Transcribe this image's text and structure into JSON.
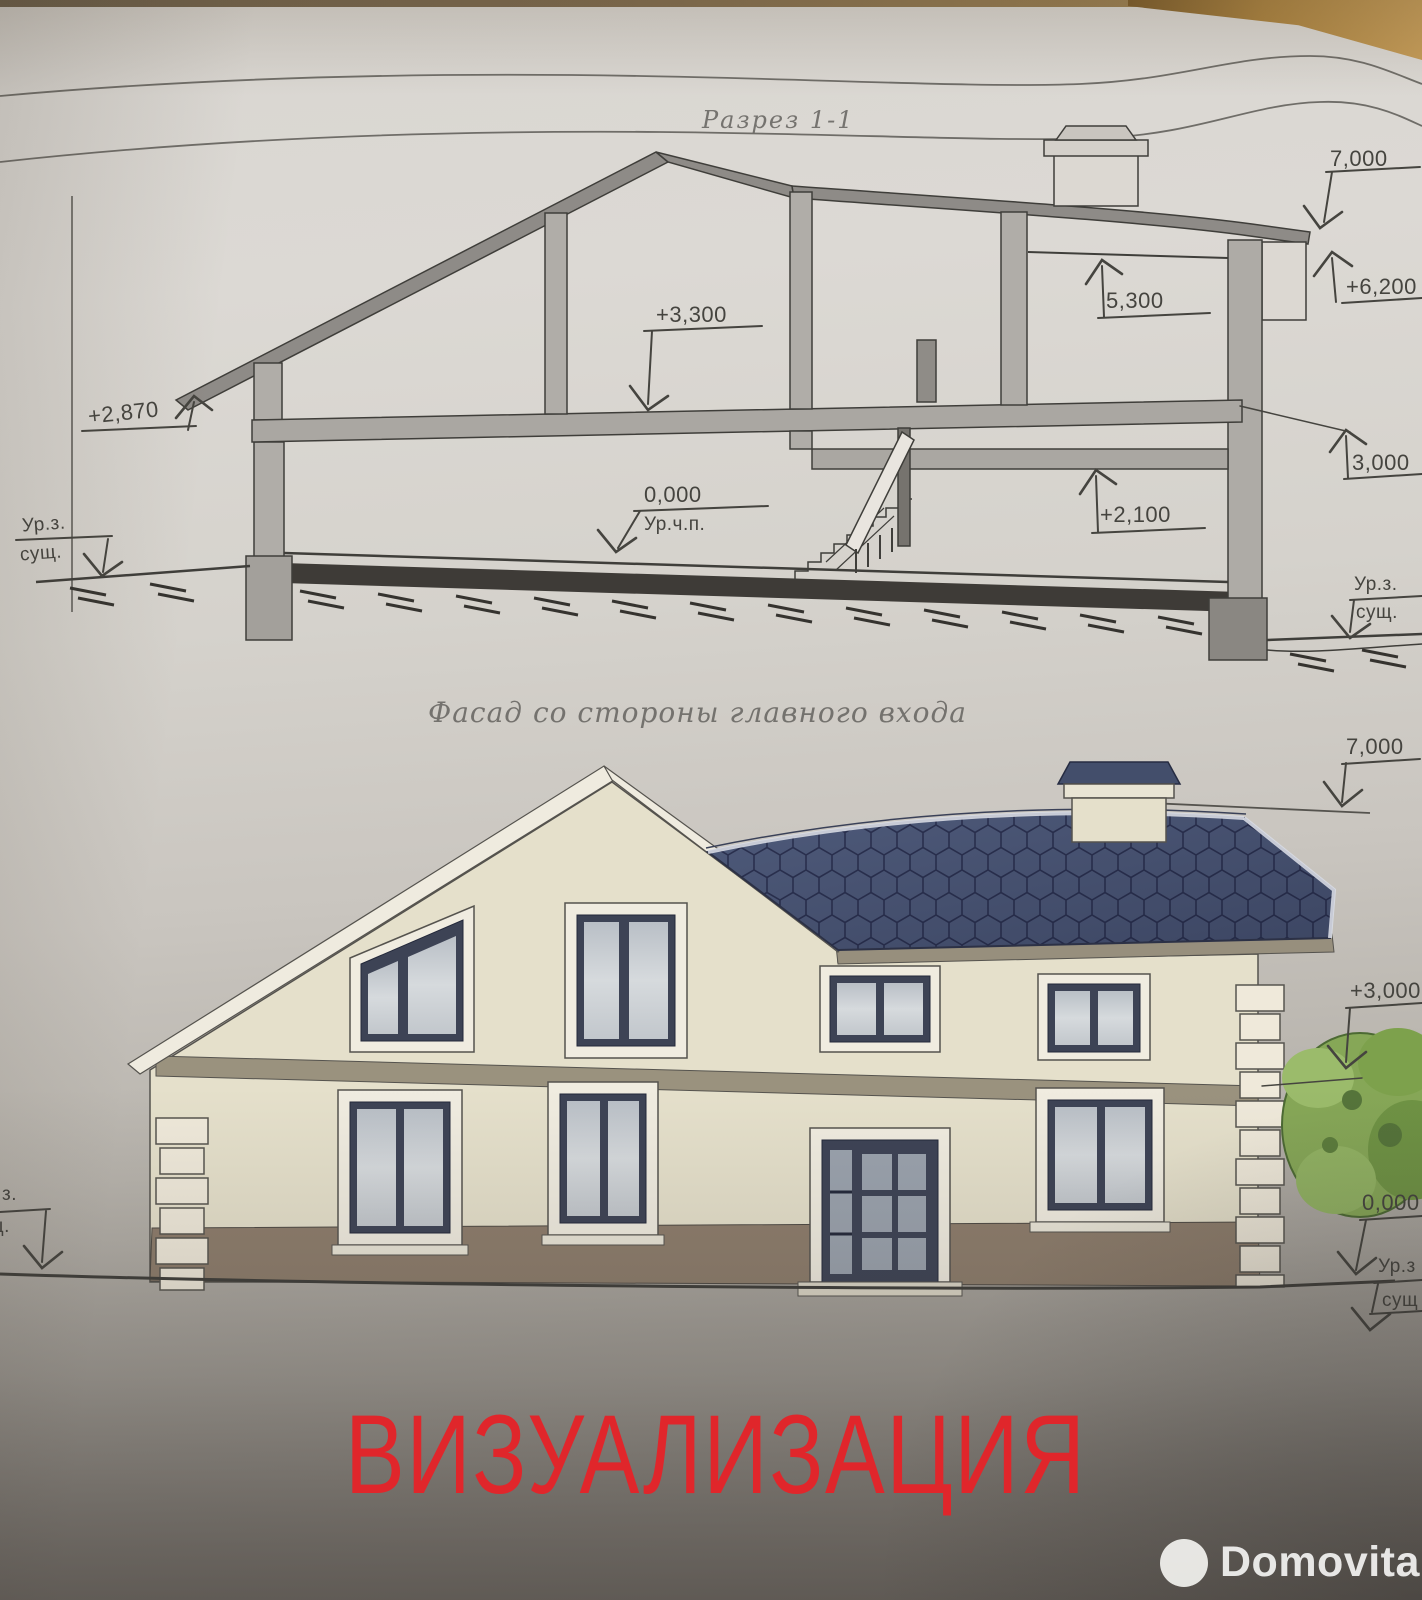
{
  "section_view": {
    "title": "Разрез 1-1",
    "dims": {
      "roof_top": "7,000",
      "eaves_right": "+6,200",
      "upper_slab": "+3,300",
      "attic_ceiling": "5,300",
      "room_ceiling_right": "+2,100",
      "floor_zero": "0,000",
      "floor_zero_note": "Ур.ч.п.",
      "eaves_left": "+2,870",
      "ground_left_level": "Ур.з.",
      "ground_left_existing": "сущ.",
      "wall_height_right": "3,000",
      "ground_right_level": "Ур.з.",
      "ground_right_existing": "сущ."
    }
  },
  "facade_view": {
    "title": "Фасад со стороны главного входа",
    "dims": {
      "roof_top": "7,000",
      "second_floor": "+3,000",
      "floor_zero": "0,000",
      "ground_right_level": "Ур.з",
      "ground_right_existing": "сущ",
      "ground_left_level_cut": "з.",
      "ground_left_existing_cut": "щ."
    }
  },
  "overlay": {
    "stamp_text": "ВИЗУАЛИЗАЦИЯ",
    "stamp_color": "#e0262b"
  },
  "watermark": {
    "brand": "Domovita"
  },
  "palette": {
    "paper": "#d8d5d0",
    "roof_blue": "#4e5a7a",
    "wall_cream": "#e5e0cb",
    "basement_brown": "#8d7d6c",
    "tree_green": "#86a757",
    "line_color": "#45443f",
    "table_tan": "#a9813e"
  }
}
